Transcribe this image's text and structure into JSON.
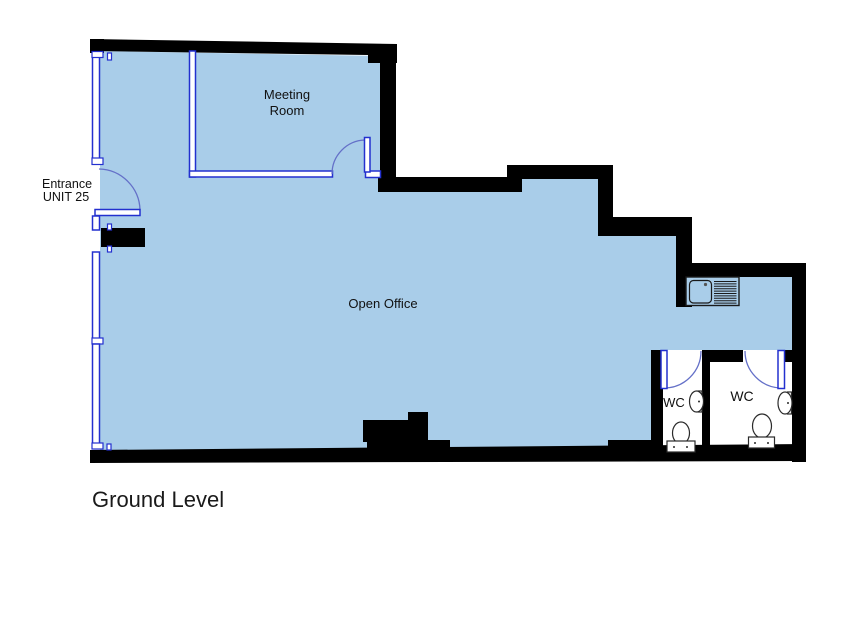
{
  "plan": {
    "labels": {
      "meeting_room_line1": "Meeting",
      "meeting_room_line2": "Room",
      "entrance_line1": "Entrance",
      "entrance_line2": "UNIT 25",
      "open_office": "Open Office",
      "wc_left": "WC",
      "wc_right": "WC"
    },
    "title": "Ground Level",
    "colors": {
      "floor": "#A9CDE9",
      "wall": "#000000",
      "frame_blue": "#2330CF",
      "door_arc_blue": "#6470C8",
      "text": "#111111",
      "background": "#FFFFFF"
    }
  }
}
